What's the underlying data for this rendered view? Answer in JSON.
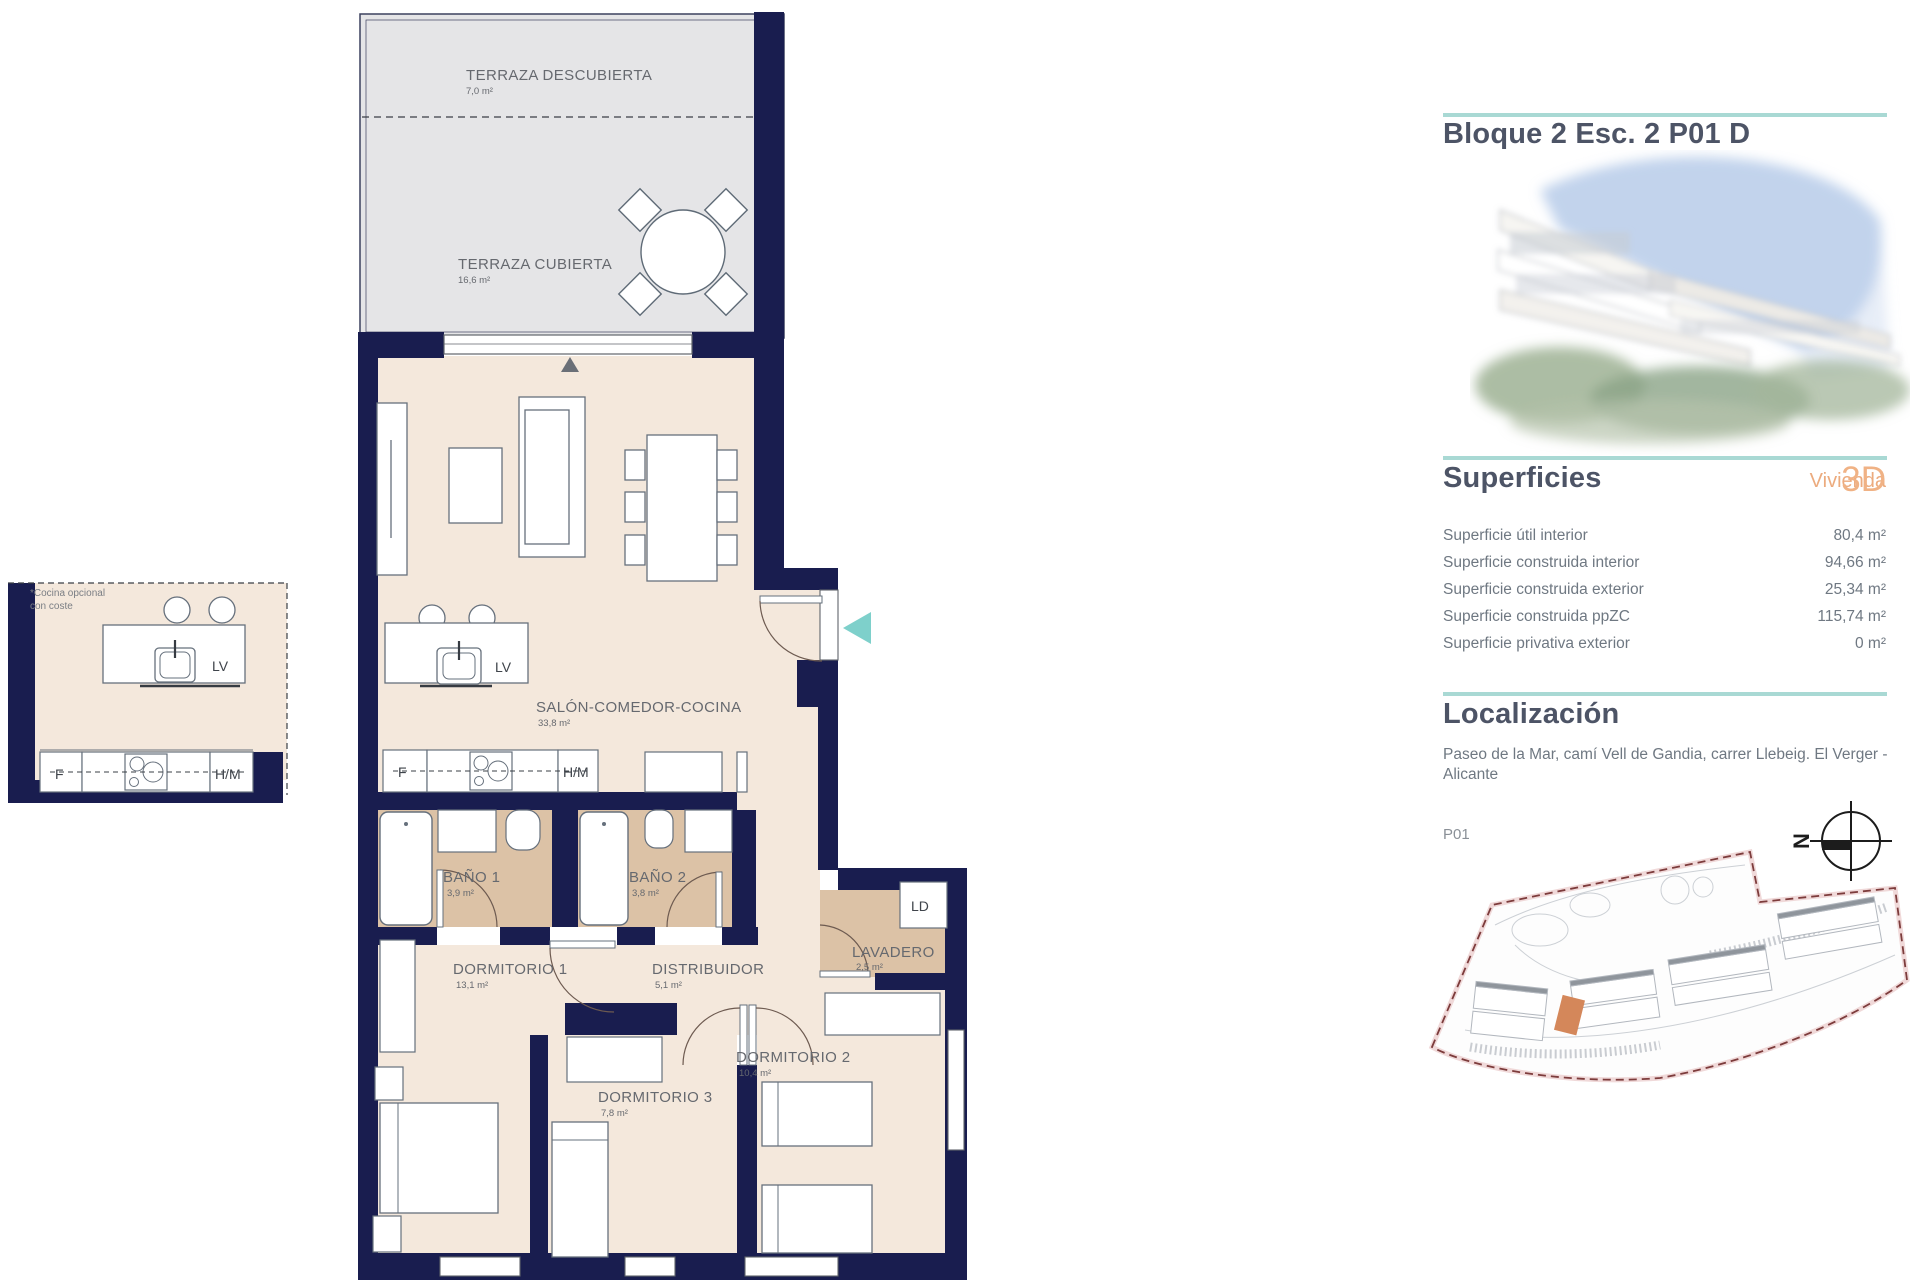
{
  "title": "Bloque 2 Esc. 2 P01 D",
  "superficies": {
    "heading": "Superficies",
    "vivienda_label": "Vivienda",
    "vivienda_type": "3D",
    "rows": [
      {
        "label": "Superficie útil interior",
        "value": "80,4 m²"
      },
      {
        "label": "Superficie construida interior",
        "value": "94,66 m²"
      },
      {
        "label": "Superficie construida exterior",
        "value": "25,34 m²"
      },
      {
        "label": "Superficie construida ppZC",
        "value": "115,74 m²"
      },
      {
        "label": "Superficie privativa exterior",
        "value": "0 m²"
      }
    ]
  },
  "localizacion": {
    "heading": "Localización",
    "address": "Paseo de la Mar, camí Vell de Gandia, carrer Llebeig. El Verger - Alicante",
    "floor_label": "P01",
    "north_letter": "N"
  },
  "plan": {
    "rooms": {
      "terraza_descubierta": {
        "name": "TERRAZA DESCUBIERTA",
        "area": "7,0 m²"
      },
      "terraza_cubierta": {
        "name": "TERRAZA CUBIERTA",
        "area": "16,6 m²"
      },
      "salon": {
        "name": "SALÓN-COMEDOR-COCINA",
        "area": "33,8 m²"
      },
      "bano1": {
        "name": "BAÑO 1",
        "area": "3,9 m²"
      },
      "bano2": {
        "name": "BAÑO 2",
        "area": "3,8 m²"
      },
      "dormitorio1": {
        "name": "DORMITORIO 1",
        "area": "13,1 m²"
      },
      "distribuidor": {
        "name": "DISTRIBUIDOR",
        "area": "5,1 m²"
      },
      "lavadero": {
        "name": "LAVADERO",
        "area": "2,5 m²"
      },
      "dormitorio2": {
        "name": "DORMITORIO 2",
        "area": "10,4 m²"
      },
      "dormitorio3": {
        "name": "DORMITORIO 3",
        "area": "7,8 m²"
      }
    },
    "labels": {
      "lv": "LV",
      "f": "F",
      "hm": "H/M",
      "ld": "LD",
      "optional_kitchen_note_line1": "*Cocina opcional",
      "optional_kitchen_note_line2": "con coste"
    }
  },
  "colors": {
    "wall": "#191d4f",
    "floor": "#f4e8dc",
    "wet_floor": "#dcc2a6",
    "terrace": "#e5e5e7",
    "accent_teal": "#a9d9d4",
    "entry_arrow": "#7ed0cb",
    "heading": "#4d5466",
    "orange": "#ecab7e",
    "siteplan_boundary": "#7d3c3c",
    "siteplan_highlight": "#d4875a"
  }
}
